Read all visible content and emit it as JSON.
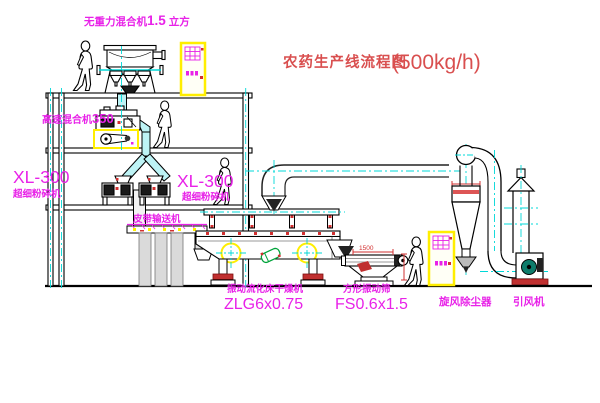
{
  "title": {
    "text": "农药生产线流程图",
    "capacity": "(500kg/h)"
  },
  "labels": {
    "gravity_mixer": {
      "name": "无重力混合机",
      "value": "1.5",
      "unit": "立方"
    },
    "high_speed_mixer": {
      "name": "高速混合机",
      "value": "350"
    },
    "mill_left": {
      "model": "XL-300",
      "name": "超细粉碎机"
    },
    "mill_right": {
      "model": "XL-300",
      "name": "超细粉碎机"
    },
    "belt_conveyor": "皮带输送机",
    "fluid_bed_dryer": {
      "name": "振动流化床干燥机",
      "model": "ZLG6x0.75"
    },
    "vibrating_screen": {
      "name": "方形振动筛",
      "model": "FS0.6x1.5"
    },
    "cyclone": "旋风除尘器",
    "induced_draft_fan": "引风机"
  },
  "dimensions": {
    "screen_length": "1500"
  },
  "colors": {
    "label_magenta": "#E822E8",
    "title_red": "#D94F4F",
    "centerline_cyan": "#00D8D8",
    "duct_fill_cyan": "#BDF3F5",
    "cabinet_yellow": "#FFEE00",
    "accent_red": "#D23030",
    "line_black": "#000000",
    "background": "#FFFFFF"
  }
}
